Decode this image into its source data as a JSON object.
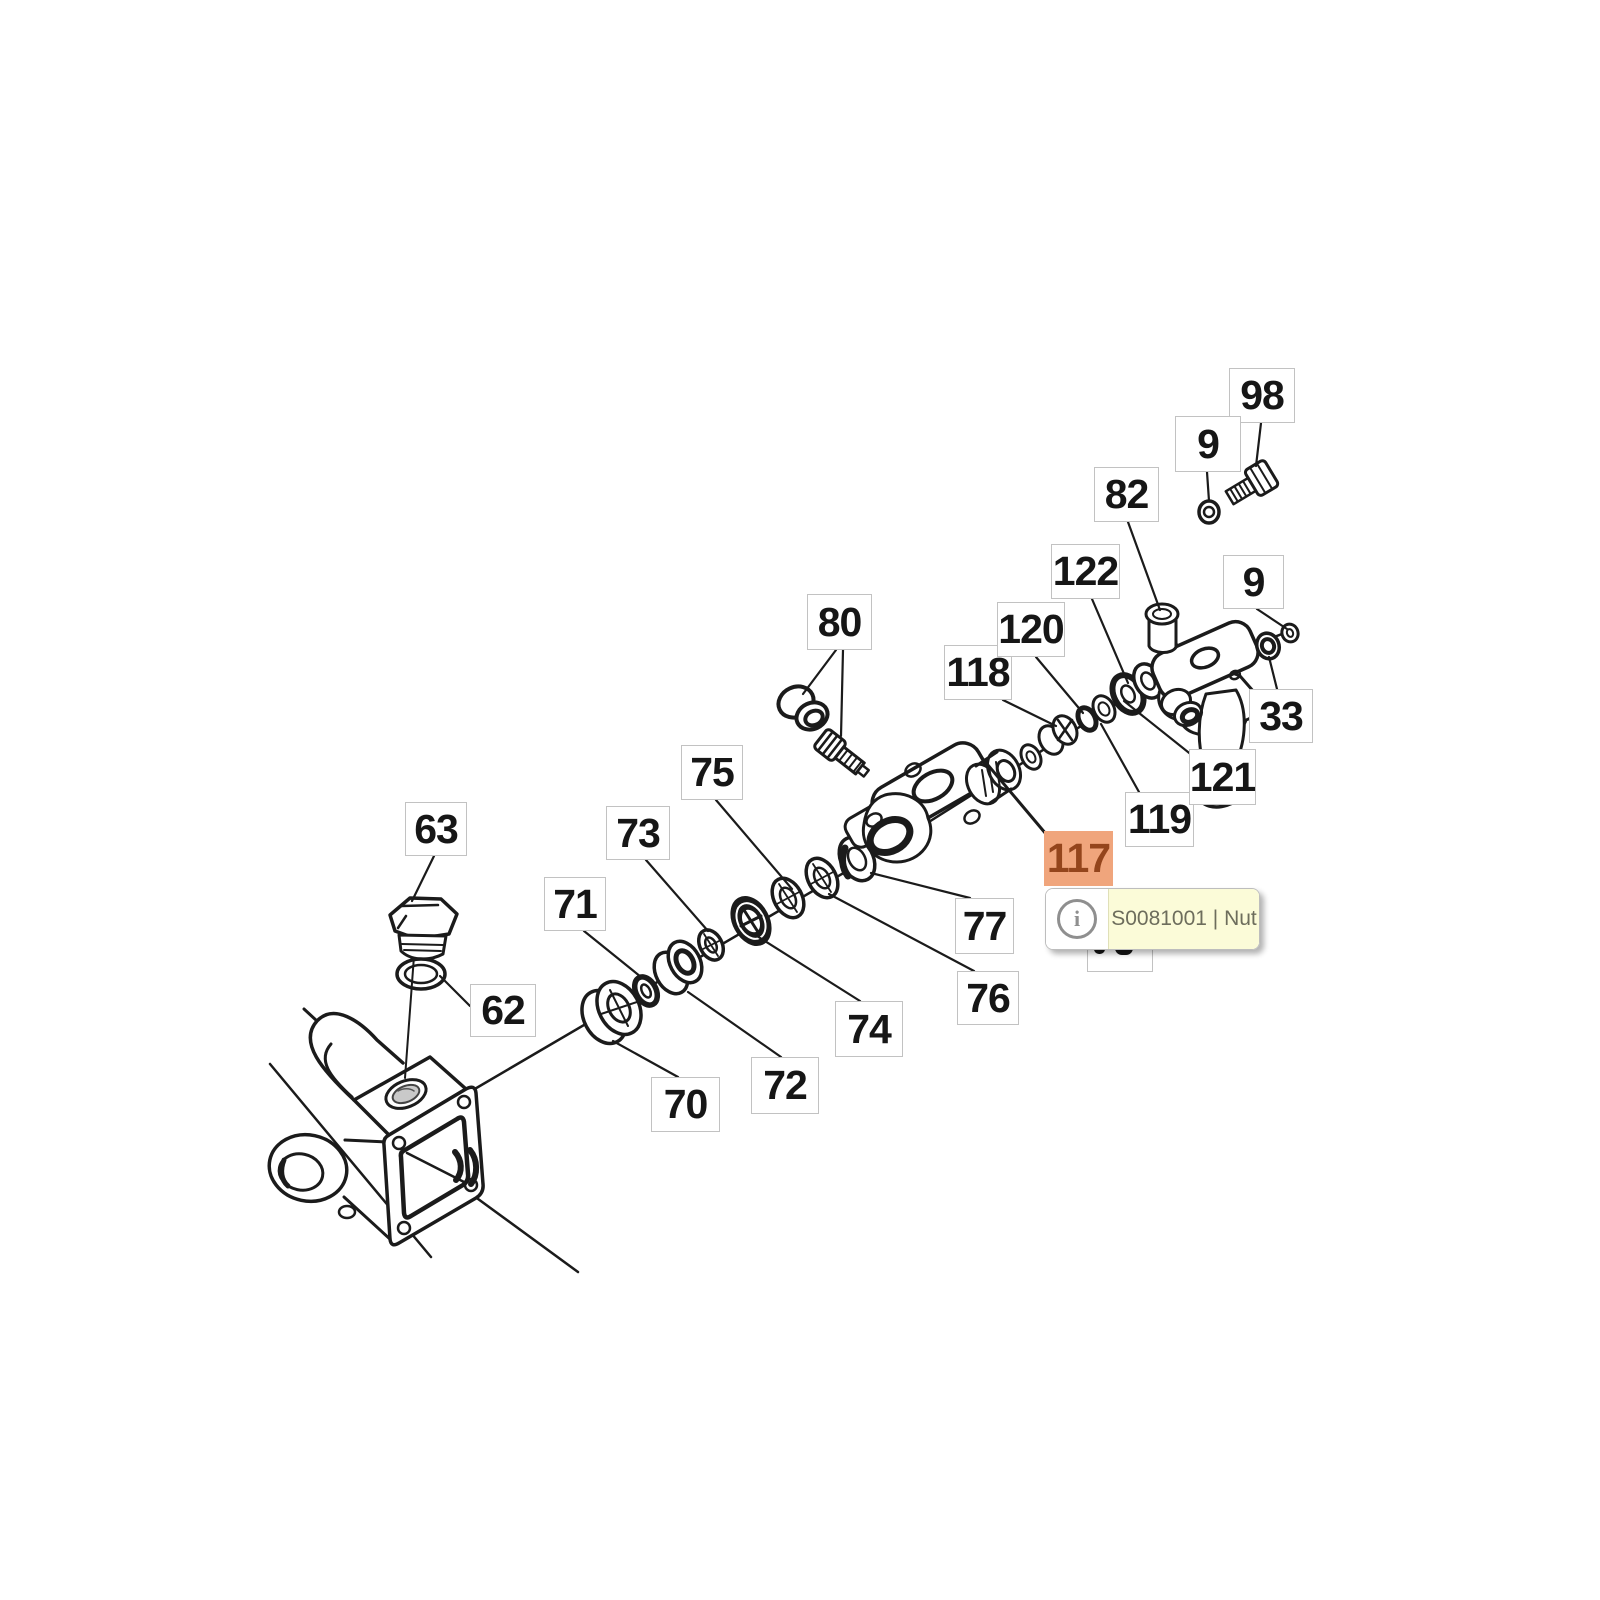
{
  "app": {
    "background": "#ffffff"
  },
  "diagram": {
    "type": "exploded-parts-diagram",
    "description_visible_text_only": true,
    "callouts": [
      {
        "text": "63",
        "x": 405,
        "y": 802,
        "w": 62,
        "h": 54
      },
      {
        "text": "73",
        "x": 606,
        "y": 806,
        "w": 64,
        "h": 54
      },
      {
        "text": "75",
        "x": 681,
        "y": 745,
        "w": 62,
        "h": 55
      },
      {
        "text": "71",
        "x": 544,
        "y": 877,
        "w": 62,
        "h": 54
      },
      {
        "text": "62",
        "x": 470,
        "y": 984,
        "w": 66,
        "h": 53
      },
      {
        "text": "70",
        "x": 651,
        "y": 1077,
        "w": 69,
        "h": 55
      },
      {
        "text": "72",
        "x": 751,
        "y": 1057,
        "w": 68,
        "h": 57
      },
      {
        "text": "74",
        "x": 835,
        "y": 1001,
        "w": 68,
        "h": 56
      },
      {
        "text": "76",
        "x": 957,
        "y": 971,
        "w": 62,
        "h": 54
      },
      {
        "text": "77",
        "x": 955,
        "y": 898,
        "w": 59,
        "h": 56
      },
      {
        "text": "80",
        "x": 807,
        "y": 594,
        "w": 65,
        "h": 56
      },
      {
        "text": "82",
        "x": 1094,
        "y": 467,
        "w": 65,
        "h": 55
      },
      {
        "text": "118",
        "x": 944,
        "y": 645,
        "w": 68,
        "h": 55
      },
      {
        "text": "120",
        "x": 997,
        "y": 602,
        "w": 68,
        "h": 55
      },
      {
        "text": "122",
        "x": 1051,
        "y": 544,
        "w": 69,
        "h": 55
      },
      {
        "text": "98",
        "x": 1229,
        "y": 368,
        "w": 66,
        "h": 55
      },
      {
        "text": "9",
        "x": 1175,
        "y": 416,
        "w": 66,
        "h": 56
      },
      {
        "text": "9",
        "x": 1223,
        "y": 555,
        "w": 61,
        "h": 54
      },
      {
        "text": "33",
        "x": 1249,
        "y": 689,
        "w": 64,
        "h": 54
      },
      {
        "text": "119",
        "x": 1125,
        "y": 792,
        "w": 69,
        "h": 55
      },
      {
        "text": "121",
        "x": 1189,
        "y": 749,
        "w": 67,
        "h": 56
      },
      {
        "text": "117",
        "x": 1044,
        "y": 831,
        "w": 69,
        "h": 55,
        "highlight": true
      },
      {
        "text": "",
        "x": 1087,
        "y": 934,
        "w": 66,
        "h": 38,
        "obscured": true
      }
    ],
    "colors": {
      "line": "#1b1b1b",
      "callout_border": "#c2c2c2",
      "callout_text": "#161616",
      "highlight_bg": "#f0a57c",
      "highlight_text": "#94451c"
    }
  },
  "tooltip": {
    "part_text": "S0081001 | Nut",
    "icon_glyph": "i",
    "colors": {
      "bg": "#fbfbd8",
      "icon_panel_bg": "#ffffff",
      "border": "#bdbdbd",
      "text": "#6d6d5c",
      "icon": "#8f8f8f"
    }
  }
}
